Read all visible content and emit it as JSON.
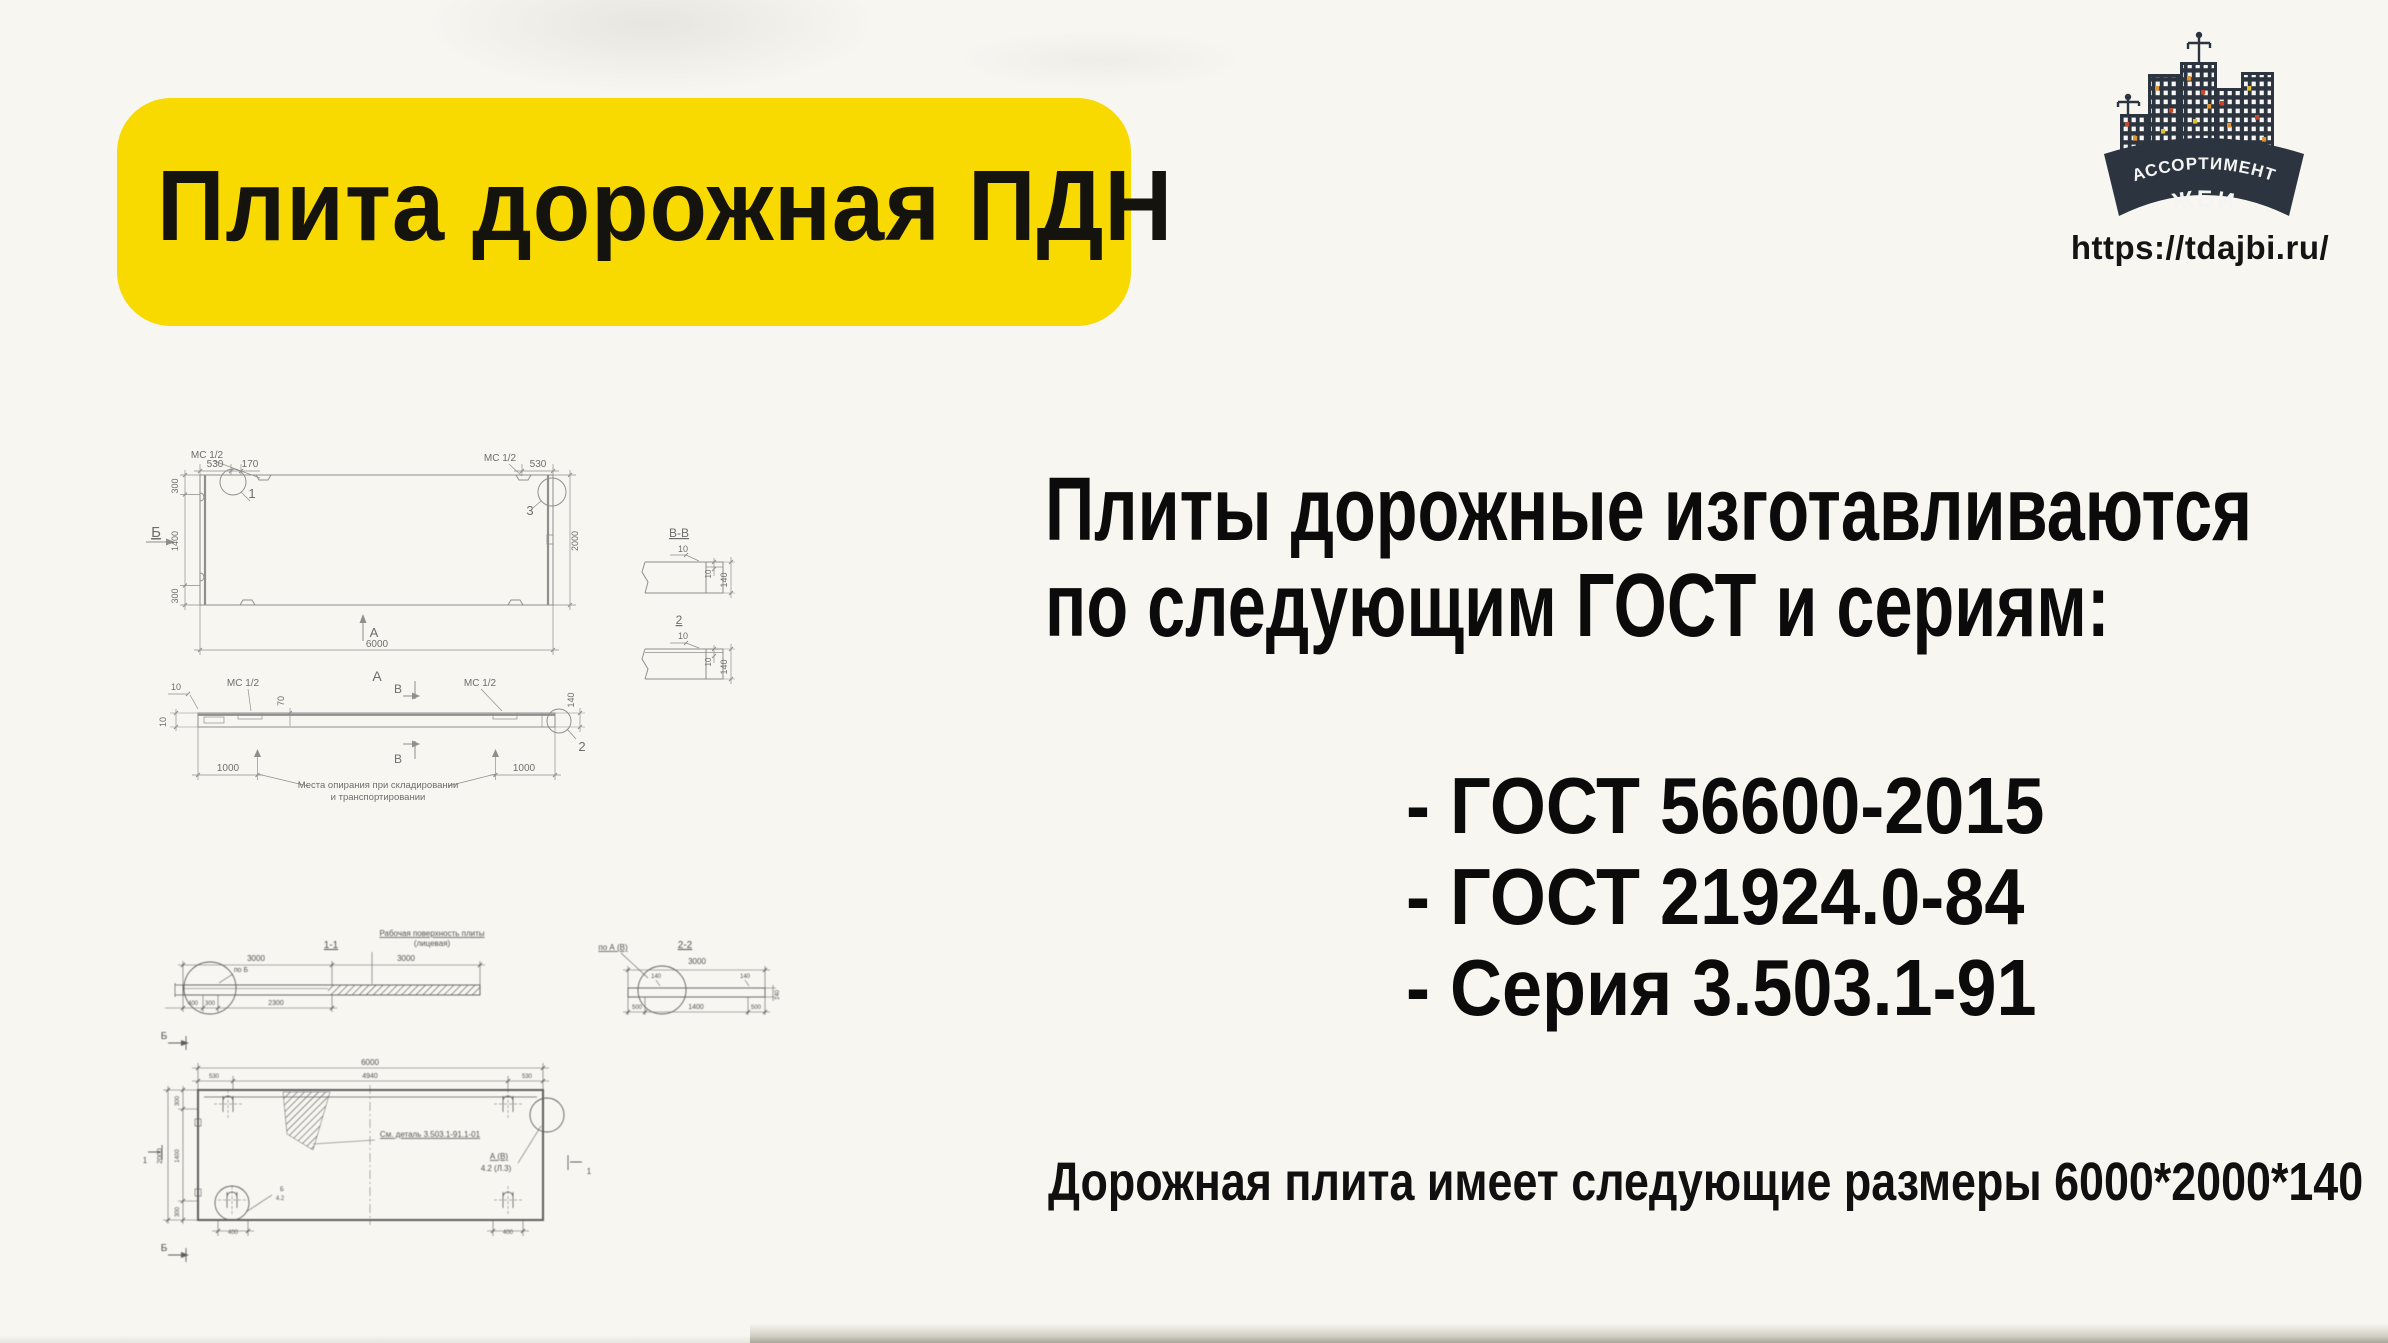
{
  "page": {
    "background": "#f8f6f1"
  },
  "title_banner": {
    "text": "Плита дорожная ПДН",
    "bg_color": "#f8d900"
  },
  "logo": {
    "banner_line1": "АССОРТИМЕНТ",
    "banner_line2": "ЖБИ",
    "url": "https://tdajbi.ru/",
    "banner_color": "#2c3440"
  },
  "intro": {
    "line1": "Плиты дорожные изготавливаются",
    "line2": "по следующим ГОСТ и сериям:"
  },
  "standards": [
    "- ГОСТ 56600-2015",
    "- ГОСТ 21924.0-84",
    "- Серия 3.503.1-91"
  ],
  "size_note": "Дорожная плита имеет следующие размеры 6000*2000*140",
  "drawing_top": {
    "description": "План и боковой вид плиты ПДН",
    "labels": [
      {
        "x": 105,
        "y": 42,
        "t": "530",
        "fs": 10
      },
      {
        "x": 140,
        "y": 42,
        "t": "170",
        "fs": 10
      },
      {
        "x": 428,
        "y": 42,
        "t": "530",
        "fs": 10
      },
      {
        "x": 97,
        "y": 33,
        "t": "МС 1/2",
        "fs": 10
      },
      {
        "x": 390,
        "y": 36,
        "t": "МС 1/2",
        "fs": 10
      },
      {
        "x": 142,
        "y": 73,
        "t": "1",
        "fs": 13
      },
      {
        "x": 420,
        "y": 90,
        "t": "3",
        "fs": 13
      },
      {
        "x": 46,
        "y": 112,
        "t": "Б",
        "fs": 15,
        "u": 1
      },
      {
        "x": 68,
        "y": 61,
        "t": "300",
        "fs": 9,
        "r": -90
      },
      {
        "x": 68,
        "y": 116,
        "t": "1400",
        "fs": 9,
        "r": -90
      },
      {
        "x": 68,
        "y": 171,
        "t": "300",
        "fs": 9,
        "r": -90
      },
      {
        "x": 468,
        "y": 116,
        "t": "2000",
        "fs": 9,
        "r": -90
      },
      {
        "x": 267,
        "y": 222,
        "t": "6000",
        "fs": 10
      },
      {
        "x": 264,
        "y": 212,
        "t": "А",
        "fs": 13
      },
      {
        "x": 267,
        "y": 256,
        "t": "А",
        "fs": 14
      },
      {
        "x": 133,
        "y": 261,
        "t": "МС 1/2",
        "fs": 10
      },
      {
        "x": 370,
        "y": 261,
        "t": "МС 1/2",
        "fs": 10
      },
      {
        "x": 66,
        "y": 265,
        "t": "10",
        "fs": 9
      },
      {
        "x": 56,
        "y": 297,
        "t": "10",
        "fs": 9,
        "r": -90
      },
      {
        "x": 174,
        "y": 276,
        "t": "70",
        "fs": 9,
        "r": -90
      },
      {
        "x": 288,
        "y": 268,
        "t": "В",
        "fs": 12
      },
      {
        "x": 288,
        "y": 338,
        "t": "В",
        "fs": 12
      },
      {
        "x": 118,
        "y": 346,
        "t": "1000",
        "fs": 10
      },
      {
        "x": 414,
        "y": 346,
        "t": "1000",
        "fs": 10
      },
      {
        "x": 268,
        "y": 363,
        "t": "Места опирания при складировании",
        "fs": 9.5
      },
      {
        "x": 268,
        "y": 375,
        "t": "и транспортировании",
        "fs": 9.5
      },
      {
        "x": 472,
        "y": 326,
        "t": "2",
        "fs": 13
      },
      {
        "x": 464,
        "y": 275,
        "t": "140",
        "fs": 9,
        "r": -90
      },
      {
        "x": 569,
        "y": 112,
        "t": "В-В",
        "fs": 12,
        "u": 1
      },
      {
        "x": 573,
        "y": 127,
        "t": "10",
        "fs": 9
      },
      {
        "x": 601,
        "y": 149,
        "t": "10",
        "fs": 8,
        "r": -90
      },
      {
        "x": 617,
        "y": 155,
        "t": "140",
        "fs": 9,
        "r": -90
      },
      {
        "x": 569,
        "y": 199,
        "t": "2",
        "fs": 12,
        "u": 1
      },
      {
        "x": 573,
        "y": 214,
        "t": "10",
        "fs": 9
      },
      {
        "x": 601,
        "y": 237,
        "t": "10",
        "fs": 8,
        "r": -90
      },
      {
        "x": 617,
        "y": 242,
        "t": "140",
        "fs": 9,
        "r": -90
      }
    ]
  },
  "drawing_bottom": {
    "description": "Сечения 1-1, 2-2 и план плиты (скан серии)",
    "labels": [
      {
        "x": 231,
        "y": 48,
        "t": "1-1",
        "fs": 10,
        "u": 1
      },
      {
        "x": 332,
        "y": 36,
        "t": "Рабочая поверхность плиты",
        "fs": 8,
        "u": 1
      },
      {
        "x": 332,
        "y": 46,
        "t": "(лицевая)",
        "fs": 8
      },
      {
        "x": 156,
        "y": 61,
        "t": "3000",
        "fs": 8
      },
      {
        "x": 306,
        "y": 61,
        "t": "3000",
        "fs": 8
      },
      {
        "x": 141,
        "y": 72,
        "t": "по Б",
        "fs": 7
      },
      {
        "x": 93,
        "y": 105,
        "t": "400",
        "fs": 6
      },
      {
        "x": 110,
        "y": 105,
        "t": "300",
        "fs": 6
      },
      {
        "x": 176,
        "y": 105,
        "t": "2300",
        "fs": 7
      },
      {
        "x": 513,
        "y": 50,
        "t": "по А (В)",
        "fs": 8,
        "u": 1
      },
      {
        "x": 585,
        "y": 48,
        "t": "2-2",
        "fs": 10,
        "u": 1
      },
      {
        "x": 597,
        "y": 64,
        "t": "3000",
        "fs": 8
      },
      {
        "x": 556,
        "y": 78,
        "t": "140",
        "fs": 6
      },
      {
        "x": 645,
        "y": 78,
        "t": "140",
        "fs": 6
      },
      {
        "x": 537,
        "y": 109,
        "t": "500",
        "fs": 6
      },
      {
        "x": 596,
        "y": 109,
        "t": "1400",
        "fs": 7
      },
      {
        "x": 656,
        "y": 109,
        "t": "500",
        "fs": 6
      },
      {
        "x": 679,
        "y": 95,
        "t": "140",
        "fs": 6,
        "r": -90
      },
      {
        "x": 64,
        "y": 139,
        "t": "Б",
        "fs": 10
      },
      {
        "x": 64,
        "y": 351,
        "t": "Б",
        "fs": 10
      },
      {
        "x": 270,
        "y": 165,
        "t": "6000",
        "fs": 8
      },
      {
        "x": 114,
        "y": 178,
        "t": "530",
        "fs": 6
      },
      {
        "x": 270,
        "y": 178,
        "t": "4940",
        "fs": 7
      },
      {
        "x": 427,
        "y": 178,
        "t": "530",
        "fs": 6
      },
      {
        "x": 330,
        "y": 237,
        "t": "См. деталь 3.503.1-91.1-01",
        "fs": 8,
        "u": 1
      },
      {
        "x": 399,
        "y": 259,
        "t": "А (В)",
        "fs": 8,
        "u": 1
      },
      {
        "x": 396,
        "y": 271,
        "t": "4.2 (Л.3)",
        "fs": 8
      },
      {
        "x": 79,
        "y": 201,
        "t": "300",
        "fs": 6,
        "r": -90
      },
      {
        "x": 79,
        "y": 256,
        "t": "1400",
        "fs": 6,
        "r": -90
      },
      {
        "x": 79,
        "y": 312,
        "t": "300",
        "fs": 6,
        "r": -90
      },
      {
        "x": 62,
        "y": 256,
        "t": "2000",
        "fs": 7,
        "r": -90
      },
      {
        "x": 45,
        "y": 263,
        "t": "1",
        "fs": 8
      },
      {
        "x": 489,
        "y": 274,
        "t": "1",
        "fs": 8
      },
      {
        "x": 133,
        "y": 334,
        "t": "400",
        "fs": 6
      },
      {
        "x": 408,
        "y": 334,
        "t": "400",
        "fs": 6
      },
      {
        "x": 182,
        "y": 291,
        "t": "Б",
        "fs": 6
      },
      {
        "x": 180,
        "y": 300,
        "t": "4.2",
        "fs": 6
      }
    ]
  }
}
